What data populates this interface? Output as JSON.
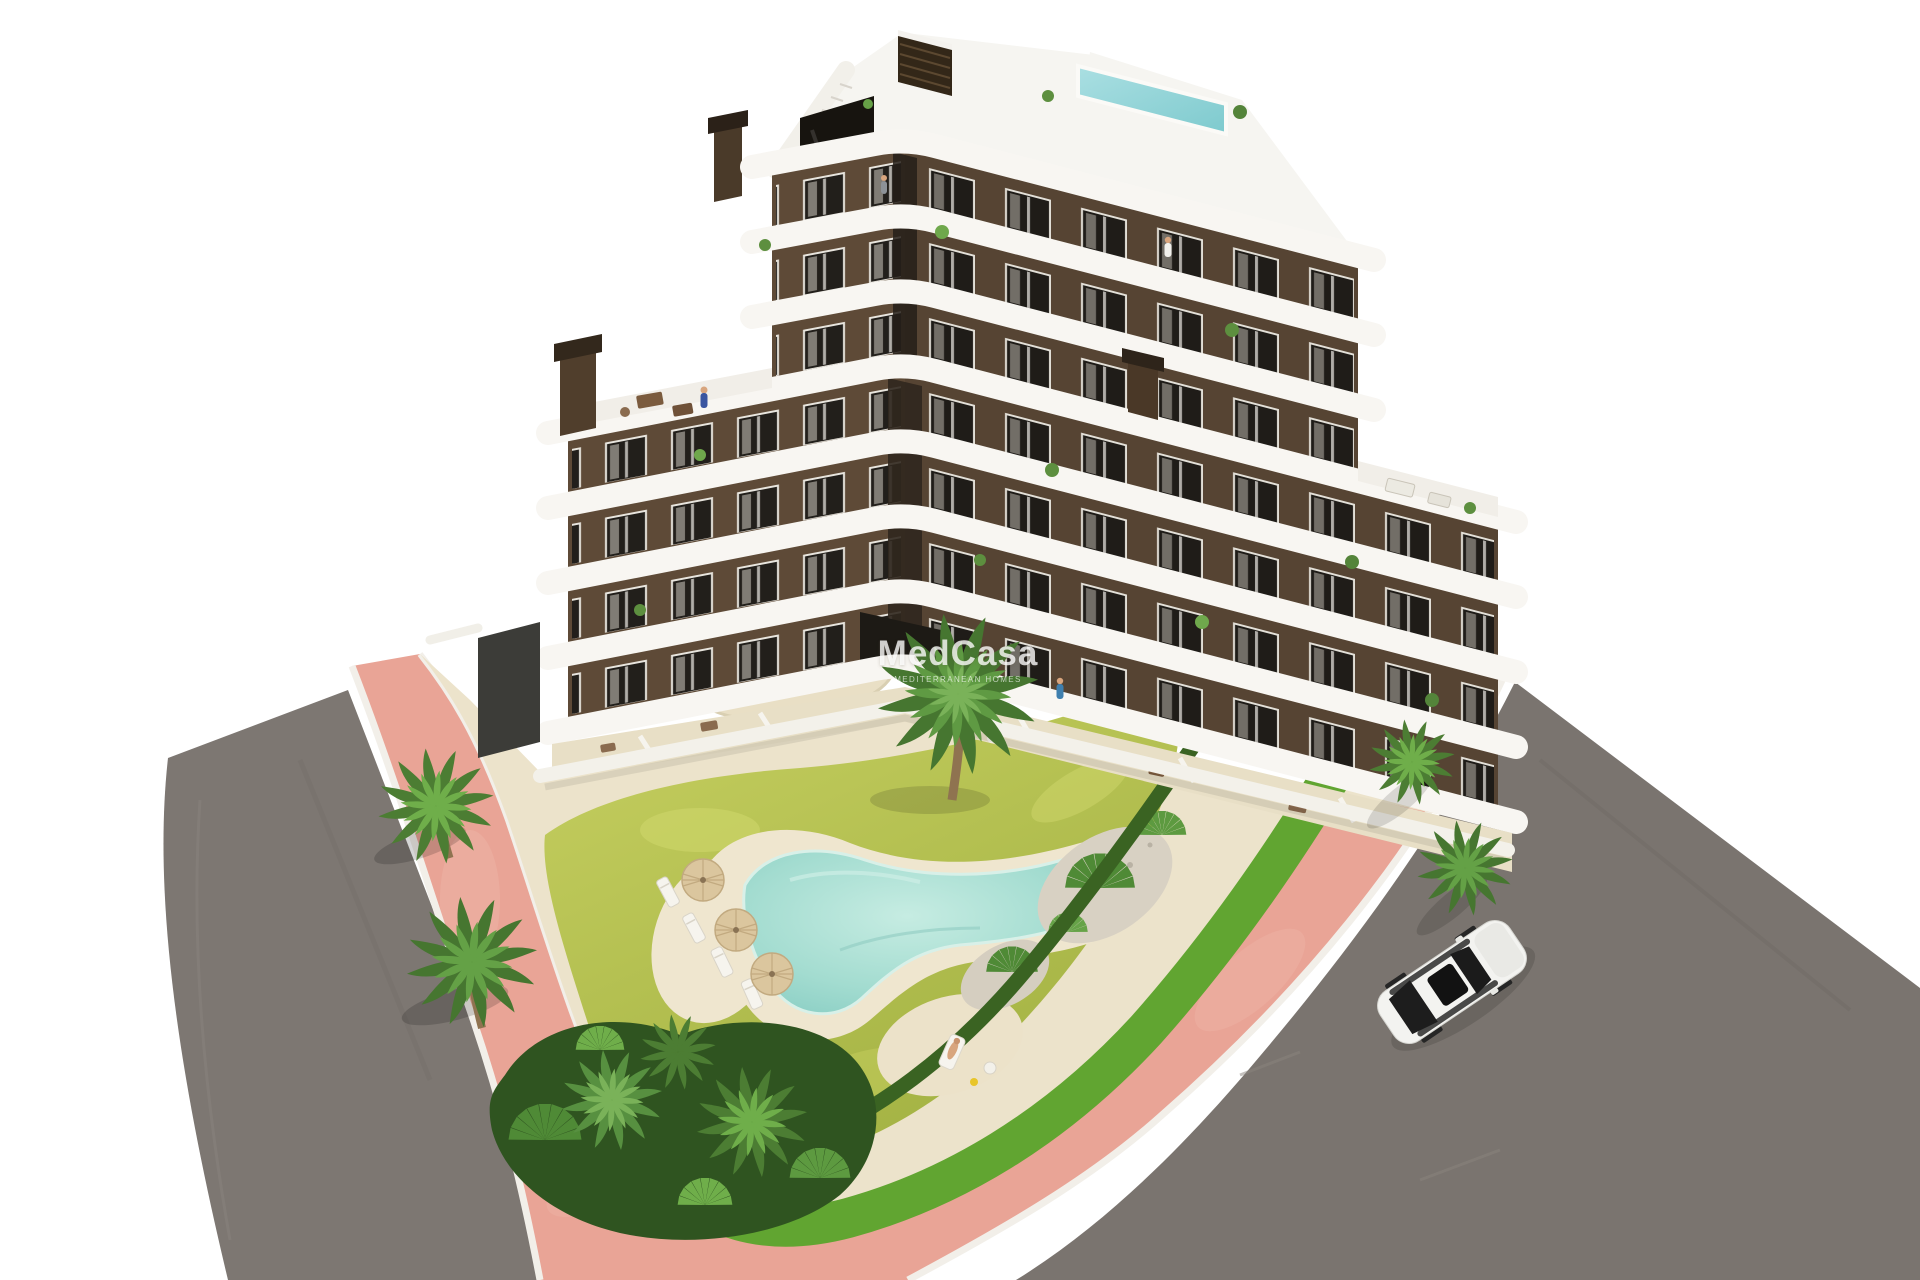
{
  "meta": {
    "kind": "architectural-aerial-render",
    "description": "Aerial 3D render of a 7-storey apartment building with curved white balcony bands and brown facade, rooftop plunge pool, landscaped garden with free-form swimming pool, parasols and sun loungers, palm trees, hedges, pink pedestrian sidewalks with white curbs, two asphalt roads and a white car",
    "canvas": {
      "width": 1920,
      "height": 1280
    },
    "background": "#ffffff"
  },
  "watermark": {
    "title": "MedCasa",
    "subtitle": "MEDITERRANEAN HOMES",
    "color": "#ffffff"
  },
  "palette": {
    "facade_brown": "#5e4a37",
    "facade_shadow": "#2e241a",
    "band_white": "#f8f6f2",
    "window_dark": "#221f1b",
    "roof_white": "#f6f5f1",
    "rooftop_pool": "#8fd4da",
    "garden_pool": "#9fd8cc",
    "pool_deck": "#efe6cf",
    "sand_path": "#ece3cb",
    "lawn_yellow_green": "#b7c254",
    "grass_bright": "#61a531",
    "hedge_dark": "#3a6322",
    "palm_green": "#579040",
    "trunk_brown": "#8f7350",
    "sidewalk_pink": "#e9a496",
    "curb_white": "#f2efe9",
    "asphalt_gray": "#7b7570",
    "car_white": "#f3f3f0"
  },
  "scene": {
    "building": {
      "label": "apartment building",
      "floors": 7,
      "features": [
        "curved white balcony bands",
        "brown facade",
        "rooftop plunge pool",
        "roof access stair",
        "chimneys",
        "terraces with furniture and plants"
      ]
    },
    "garden": {
      "label": "landscaped garden",
      "features": [
        "free-form turquoise pool",
        "cream pool deck",
        "three parasols",
        "sun loungers",
        "palm trees",
        "dark hedge",
        "bright grass strip",
        "gravel beds",
        "yellow-green lawn"
      ]
    },
    "streets": {
      "label": "surrounding streets",
      "features": [
        "pink paved sidewalk ribbon",
        "white curbs",
        "left asphalt road",
        "right asphalt road"
      ]
    },
    "vehicle": {
      "label": "white car driving on right road",
      "color": "#f3f3f0"
    }
  }
}
